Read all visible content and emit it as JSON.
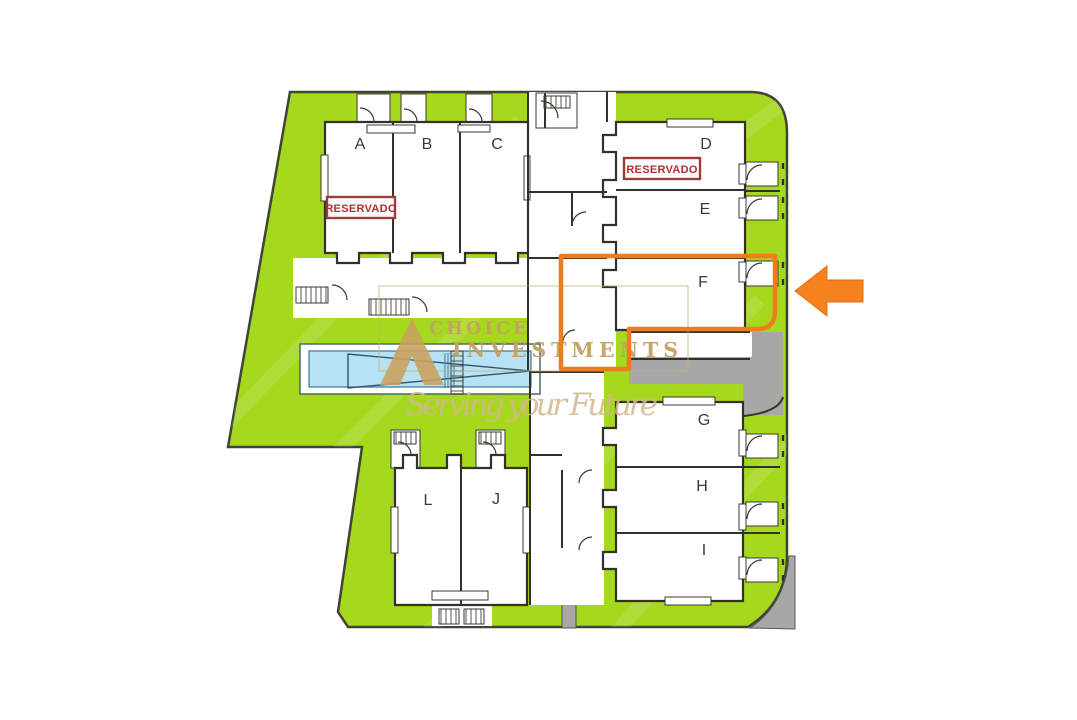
{
  "plan": {
    "units": [
      {
        "label": "A"
      },
      {
        "label": "B"
      },
      {
        "label": "C"
      },
      {
        "label": "D"
      },
      {
        "label": "E"
      },
      {
        "label": "F"
      },
      {
        "label": "G"
      },
      {
        "label": "H"
      },
      {
        "label": "I"
      },
      {
        "label": "L"
      },
      {
        "label": "J"
      }
    ],
    "stamps": {
      "unit_a": "RESERVADO",
      "unit_d": "RESERVADO"
    },
    "highlight": {
      "highlighted_unit": "F"
    },
    "colors": {
      "plot_green": "#a6d81e",
      "highlight_orange": "#ee7c1f",
      "arrow_orange": "#f5821f",
      "stamp_red": "#ae2f2f",
      "watermark_gold": "#c4a263",
      "watermark_gold_light": "#d2b88c",
      "pool_blue": "#b7e2f4",
      "driveway_gray": "#a7a7a7",
      "wall_dark": "#32322b"
    }
  },
  "watermark": {
    "brand_line1": "CHOICE",
    "brand_line2": "INVESTMENTS",
    "tagline": "Serving your Future"
  }
}
